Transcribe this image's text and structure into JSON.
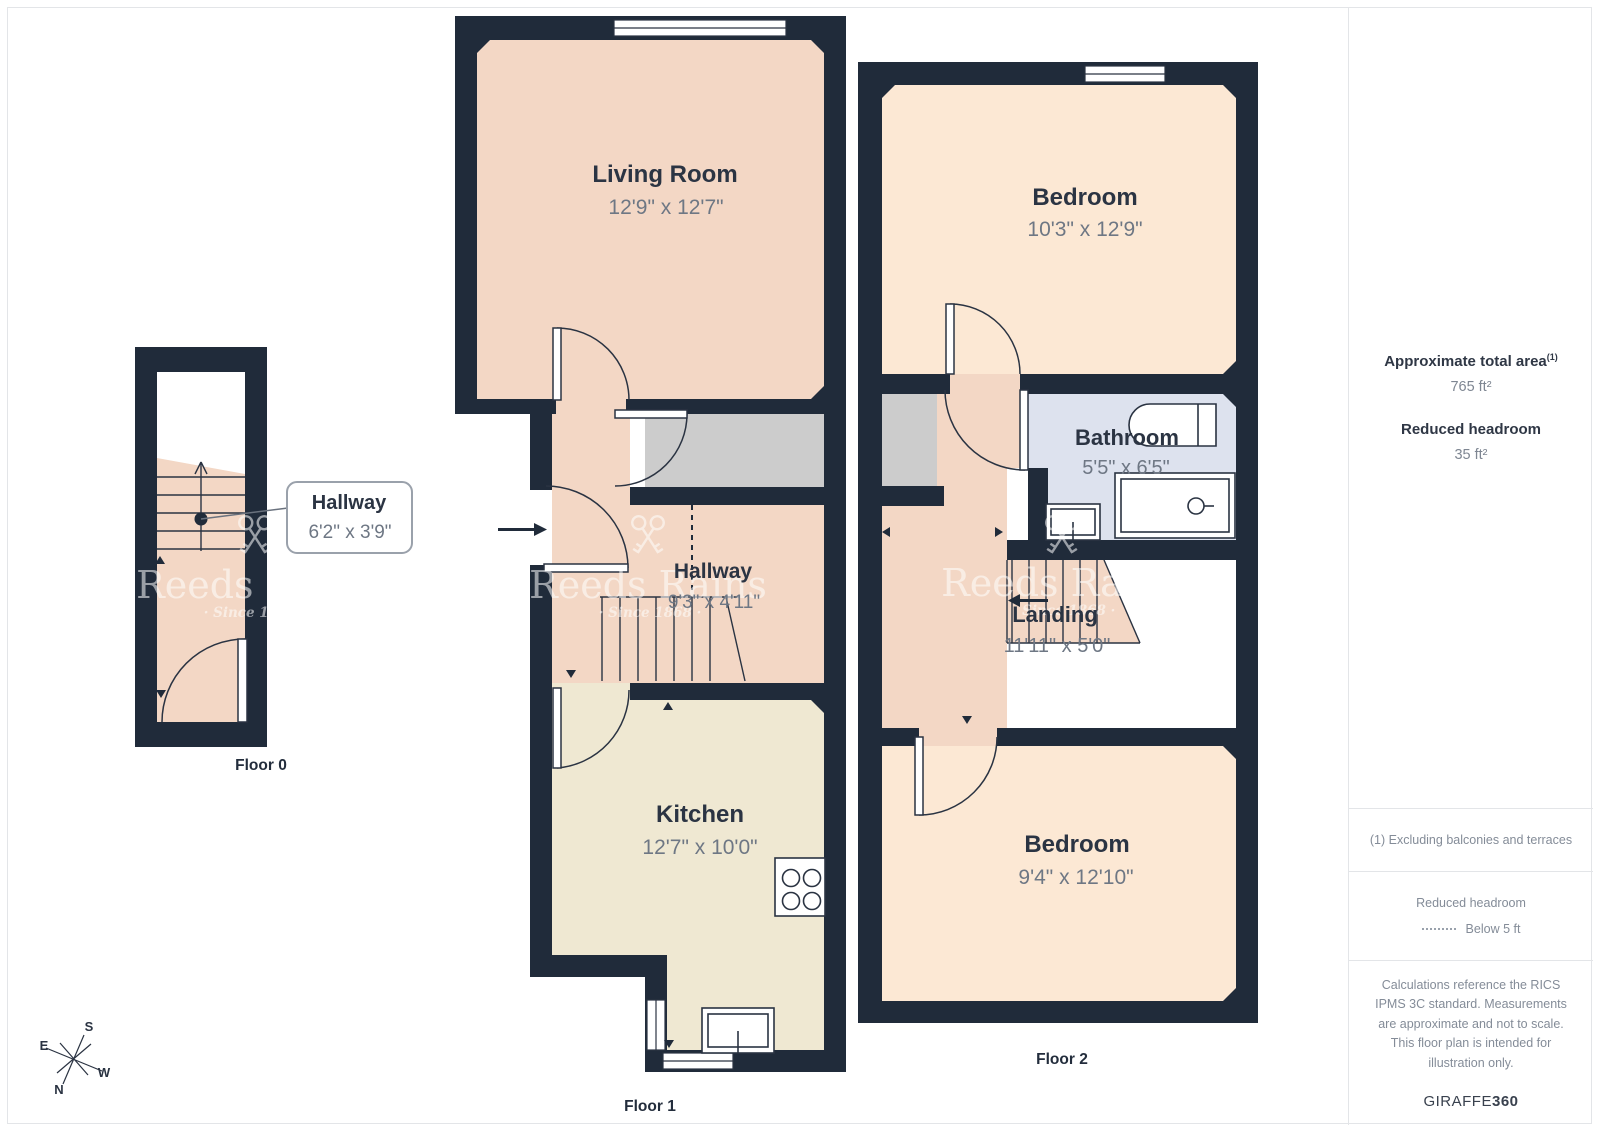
{
  "floors": {
    "floor0": {
      "label": "Floor 0",
      "rooms": {
        "hallway": {
          "name": "Hallway",
          "dims": "6'2\" x 3'9\""
        }
      }
    },
    "floor1": {
      "label": "Floor 1",
      "rooms": {
        "living": {
          "name": "Living Room",
          "dims": "12'9\" x 12'7\""
        },
        "hallway": {
          "name": "Hallway",
          "dims": "9'3\" x 4'11\""
        },
        "kitchen": {
          "name": "Kitchen",
          "dims": "12'7\" x 10'0\""
        }
      }
    },
    "floor2": {
      "label": "Floor 2",
      "rooms": {
        "bedroom1": {
          "name": "Bedroom",
          "dims": "10'3\" x 12'9\""
        },
        "bathroom": {
          "name": "Bathroom",
          "dims": "5'5\" x 6'5\""
        },
        "landing": {
          "name": "Landing",
          "dims": "11'11\" x 5'0\""
        },
        "bedroom2": {
          "name": "Bedroom",
          "dims": "9'4\" x 12'10\""
        }
      }
    }
  },
  "sidebar": {
    "total_area_label": "Approximate total area",
    "total_area_sup": "(1)",
    "total_area_value": "765 ft²",
    "reduced_label": "Reduced headroom",
    "reduced_value": "35 ft²",
    "note": "(1) Excluding balconies and terraces",
    "legend_title": "Reduced headroom",
    "legend_value": "Below 5 ft",
    "disclaimer": "Calculations reference the RICS IPMS 3C standard. Measurements are approximate and not to scale. This floor plan is intended for illustration only.",
    "brand_normal": "GIRAFFE",
    "brand_bold": "360"
  },
  "watermark": {
    "brand": "Reeds Rains",
    "since": "· Since 1868 ·"
  },
  "compass": {
    "n": "N",
    "s": "S",
    "e": "E",
    "w": "W"
  },
  "colors": {
    "wall": "#202b3a",
    "room_pink": "#f3d7c5",
    "room_peach": "#fce8d4",
    "kitchen_cream": "#efe8d2",
    "bathroom_blue": "#dde2ee",
    "void_gray": "#cccccc",
    "label_dark": "#2b3443",
    "dim_gray": "#6e7784",
    "divider": "#e3e5e8"
  }
}
